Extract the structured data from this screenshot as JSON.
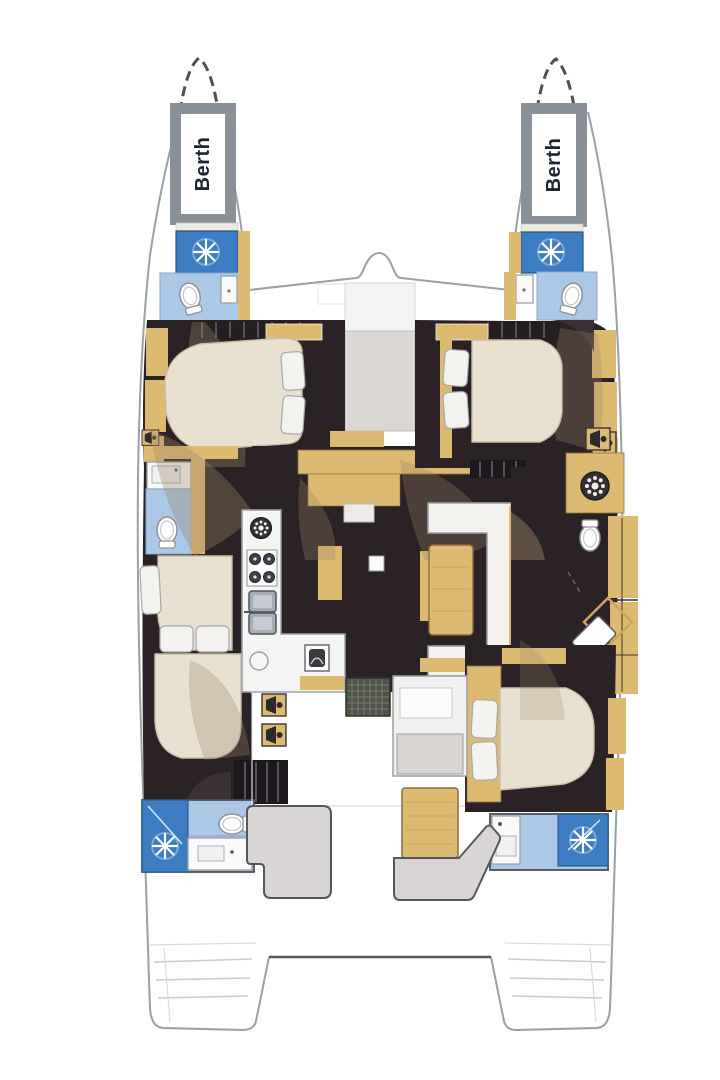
{
  "diagram": {
    "type": "catamaran-deck-plan",
    "labels": {
      "port_bow_berth": "Berth",
      "starboard_bow_berth": "Berth"
    }
  },
  "palette": {
    "hull-line": "#98a0a8",
    "outline-dark": "#4b4f56",
    "frame-gray": "#8a9097",
    "floor-dark": "#2b2226",
    "wood-tan": "#ddba72",
    "wood-tan-dark": "#b99448",
    "bed-cream": "#e9e1d0",
    "pillow-white": "#f3f2ef",
    "bath-blue": "#abc8e7",
    "shower-blue": "#3c7cc0",
    "fixture-white": "#fafaf8",
    "sofa-gray": "#d9d5d4",
    "shadow-beige": "#9b8668",
    "label-ink": "#1c2533"
  },
  "icons": {
    "shower-spray-icon": "white starburst on blue shower pad",
    "toilet-icon": "white oval bowl with tank",
    "stove-icon": "four dark burner circles",
    "double-sink-icon": "two rounded gray basins",
    "round-sink-icon": "circle outline",
    "vent-icon": "dark ring with white dots",
    "washing-machine-icon": "dark drum ring with white dots",
    "speaker-icon": "dark cone in tan square",
    "deck-grate-icon": "dark grid mat",
    "companionway-steps-icon": "dark slatted block",
    "anchor-locker-icon": "bump arc at foredeck centerline"
  }
}
